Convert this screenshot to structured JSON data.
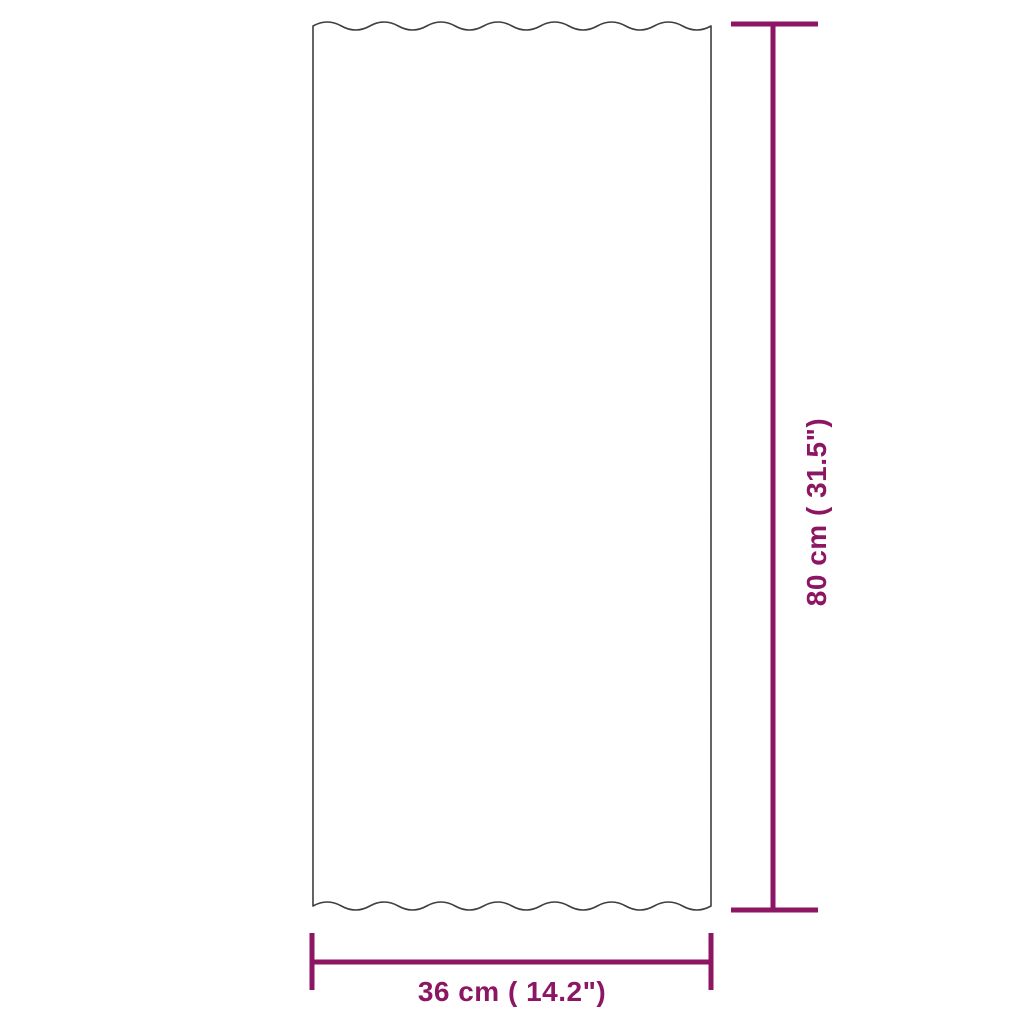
{
  "diagram": {
    "subject": "corrugated-roof-panel-front-view",
    "dimensions": {
      "vertical": {
        "label": "80 cm ( 31.5\")"
      },
      "horizontal": {
        "label": "36 cm ( 14.2\")"
      }
    },
    "colors": {
      "dimension": "#8C1663",
      "outline": "#3E3E3E",
      "background": "#FFFFFF"
    }
  }
}
